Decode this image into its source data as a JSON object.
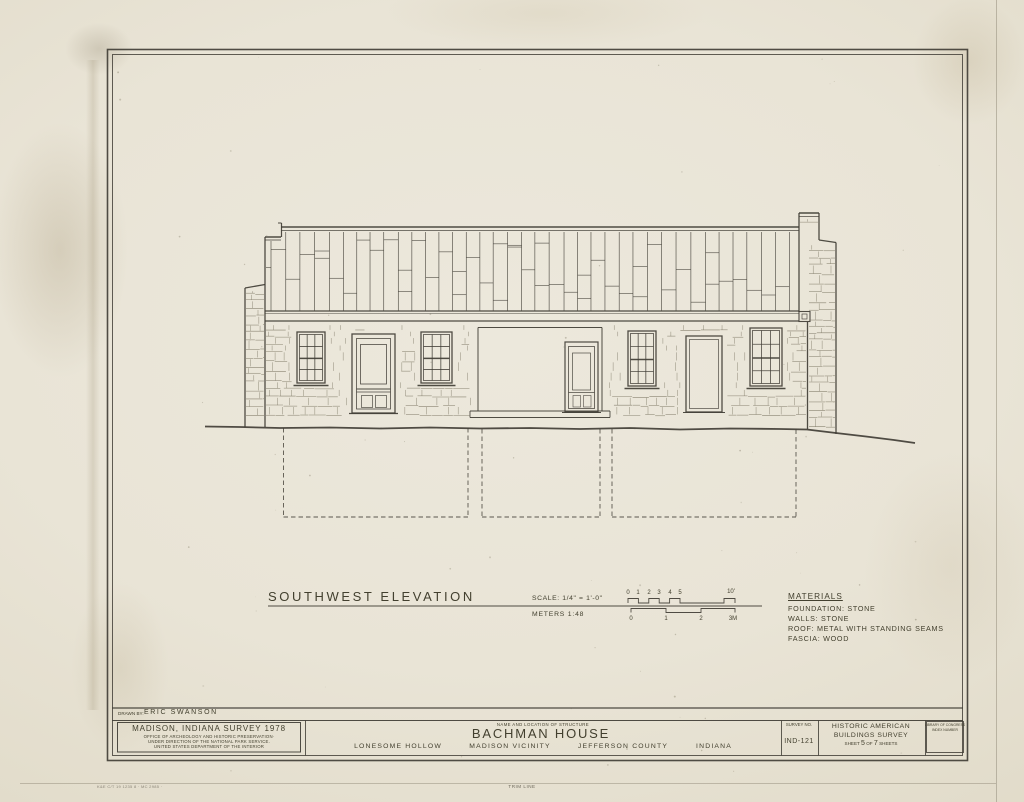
{
  "sheet": {
    "drawing_title": "SOUTHWEST ELEVATION",
    "scale_label": "SCALE: 1/4\" = 1'-0\"",
    "meters_label": "METERS  1:48",
    "feet_ticks": [
      "0",
      "1",
      "2",
      "3",
      "4",
      "5"
    ],
    "feet_end": "10'",
    "meter_ticks": [
      "0",
      "1",
      "2",
      "3M"
    ]
  },
  "materials": {
    "heading": "MATERIALS",
    "items": [
      "FOUNDATION: STONE",
      "WALLS: STONE",
      "ROOF: METAL WITH STANDING SEAMS",
      "FASCIA: WOOD"
    ]
  },
  "title_block": {
    "drawn_by_label": "DRAWN BY:",
    "drawn_by_name": "ERIC SWANSON",
    "survey_title": "MADISON, INDIANA SURVEY 1978",
    "office_line1": "OFFICE OF ARCHEOLOGY AND HISTORIC PRESERVATION·",
    "office_line2": "UNDER DIRECTION OF THE NATIONAL PARK SERVICE.",
    "office_line3": "UNITED STATES DEPARTMENT OF THE INTERIOR",
    "name_location_label": "NAME AND LOCATION OF STRUCTURE",
    "structure_name": "BACHMAN  HOUSE",
    "location_1": "LONESOME  HOLLOW",
    "location_2": "MADISON  VICINITY",
    "location_3": "JEFFERSON  COUNTY",
    "location_4": "INDIANA",
    "survey_no_label": "SURVEY NO.",
    "survey_no": "IND-121",
    "habs_line1": "HISTORIC AMERICAN",
    "habs_line2": "BUILDINGS SURVEY",
    "sheet_word": "SHEET",
    "sheet_number": "5",
    "of_word": "OF",
    "sheet_total": "7",
    "sheets_word": "SHEETS",
    "loc_line1": "LIBRARY OF CONGRESS",
    "loc_line2": "INDEX NUMBER"
  },
  "footer": {
    "stamp": "K&E C/T 19 1235 8 ·   MC 2985 ·",
    "trim_line": "TRIM LINE"
  },
  "colors": {
    "paper": "#e9e5d9",
    "ink": "#413e36",
    "stone": "#78725f",
    "faint": "#a29b8a"
  }
}
